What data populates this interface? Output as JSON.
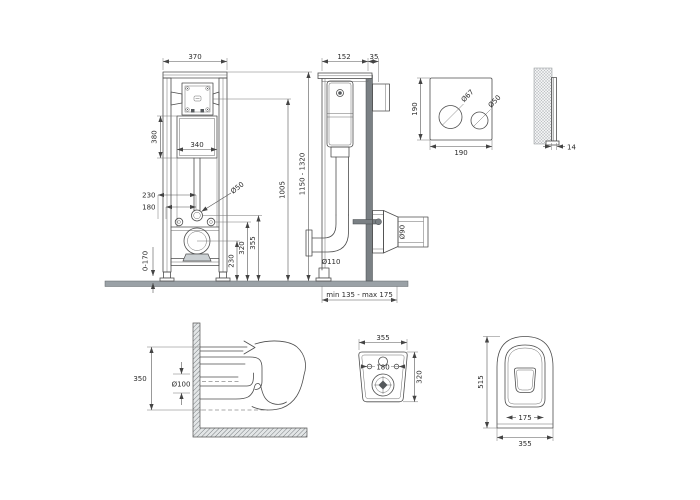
{
  "document": {
    "type": "technical-drawing",
    "background": "#ffffff",
    "line_color": "#4d4d4d",
    "ground_color": "#9aa1a6"
  },
  "views": {
    "frame_front": {
      "label": "installation-frame-front",
      "dims": {
        "frame_width": "370",
        "cistern_height": "380",
        "cistern_width": "340",
        "fixing_spacing": "230",
        "drain_spacing": "180",
        "flush_pipe_dia": "Ø50",
        "outlet_height": "230",
        "fixing_height": "320",
        "flush_height": "355",
        "cistern_top_height": "1005",
        "foot_adjustment": "0-170",
        "frame_height_range": "1150 - 1320"
      }
    },
    "frame_side": {
      "label": "installation-frame-side",
      "dims": {
        "frame_depth": "152",
        "rail_depth": "35",
        "drain_elbow_dia": "Ø110",
        "outlet_pipe_dia": "Ø90",
        "outlet_depth_range": "min 135 - max 175"
      }
    },
    "flush_plate_front": {
      "label": "flush-plate-front",
      "dims": {
        "plate_height": "190",
        "plate_width": "190",
        "big_button_dia": "Ø67",
        "small_button_dia": "Ø50"
      }
    },
    "flush_plate_side": {
      "label": "flush-plate-side",
      "dims": {
        "plate_thickness": "14"
      }
    },
    "bowl_side": {
      "label": "bowl-side-section",
      "dims": {
        "bowl_height": "350",
        "outlet_pipe_dia": "Ø100"
      }
    },
    "bowl_back": {
      "label": "bowl-back-view",
      "dims": {
        "bowl_width": "355",
        "bowl_back_height": "320",
        "fixing_hole_spacing": "180"
      }
    },
    "bowl_top": {
      "label": "bowl-top-view",
      "dims": {
        "bowl_depth": "515",
        "seat_opening_width": "175",
        "bowl_width": "355"
      }
    }
  }
}
